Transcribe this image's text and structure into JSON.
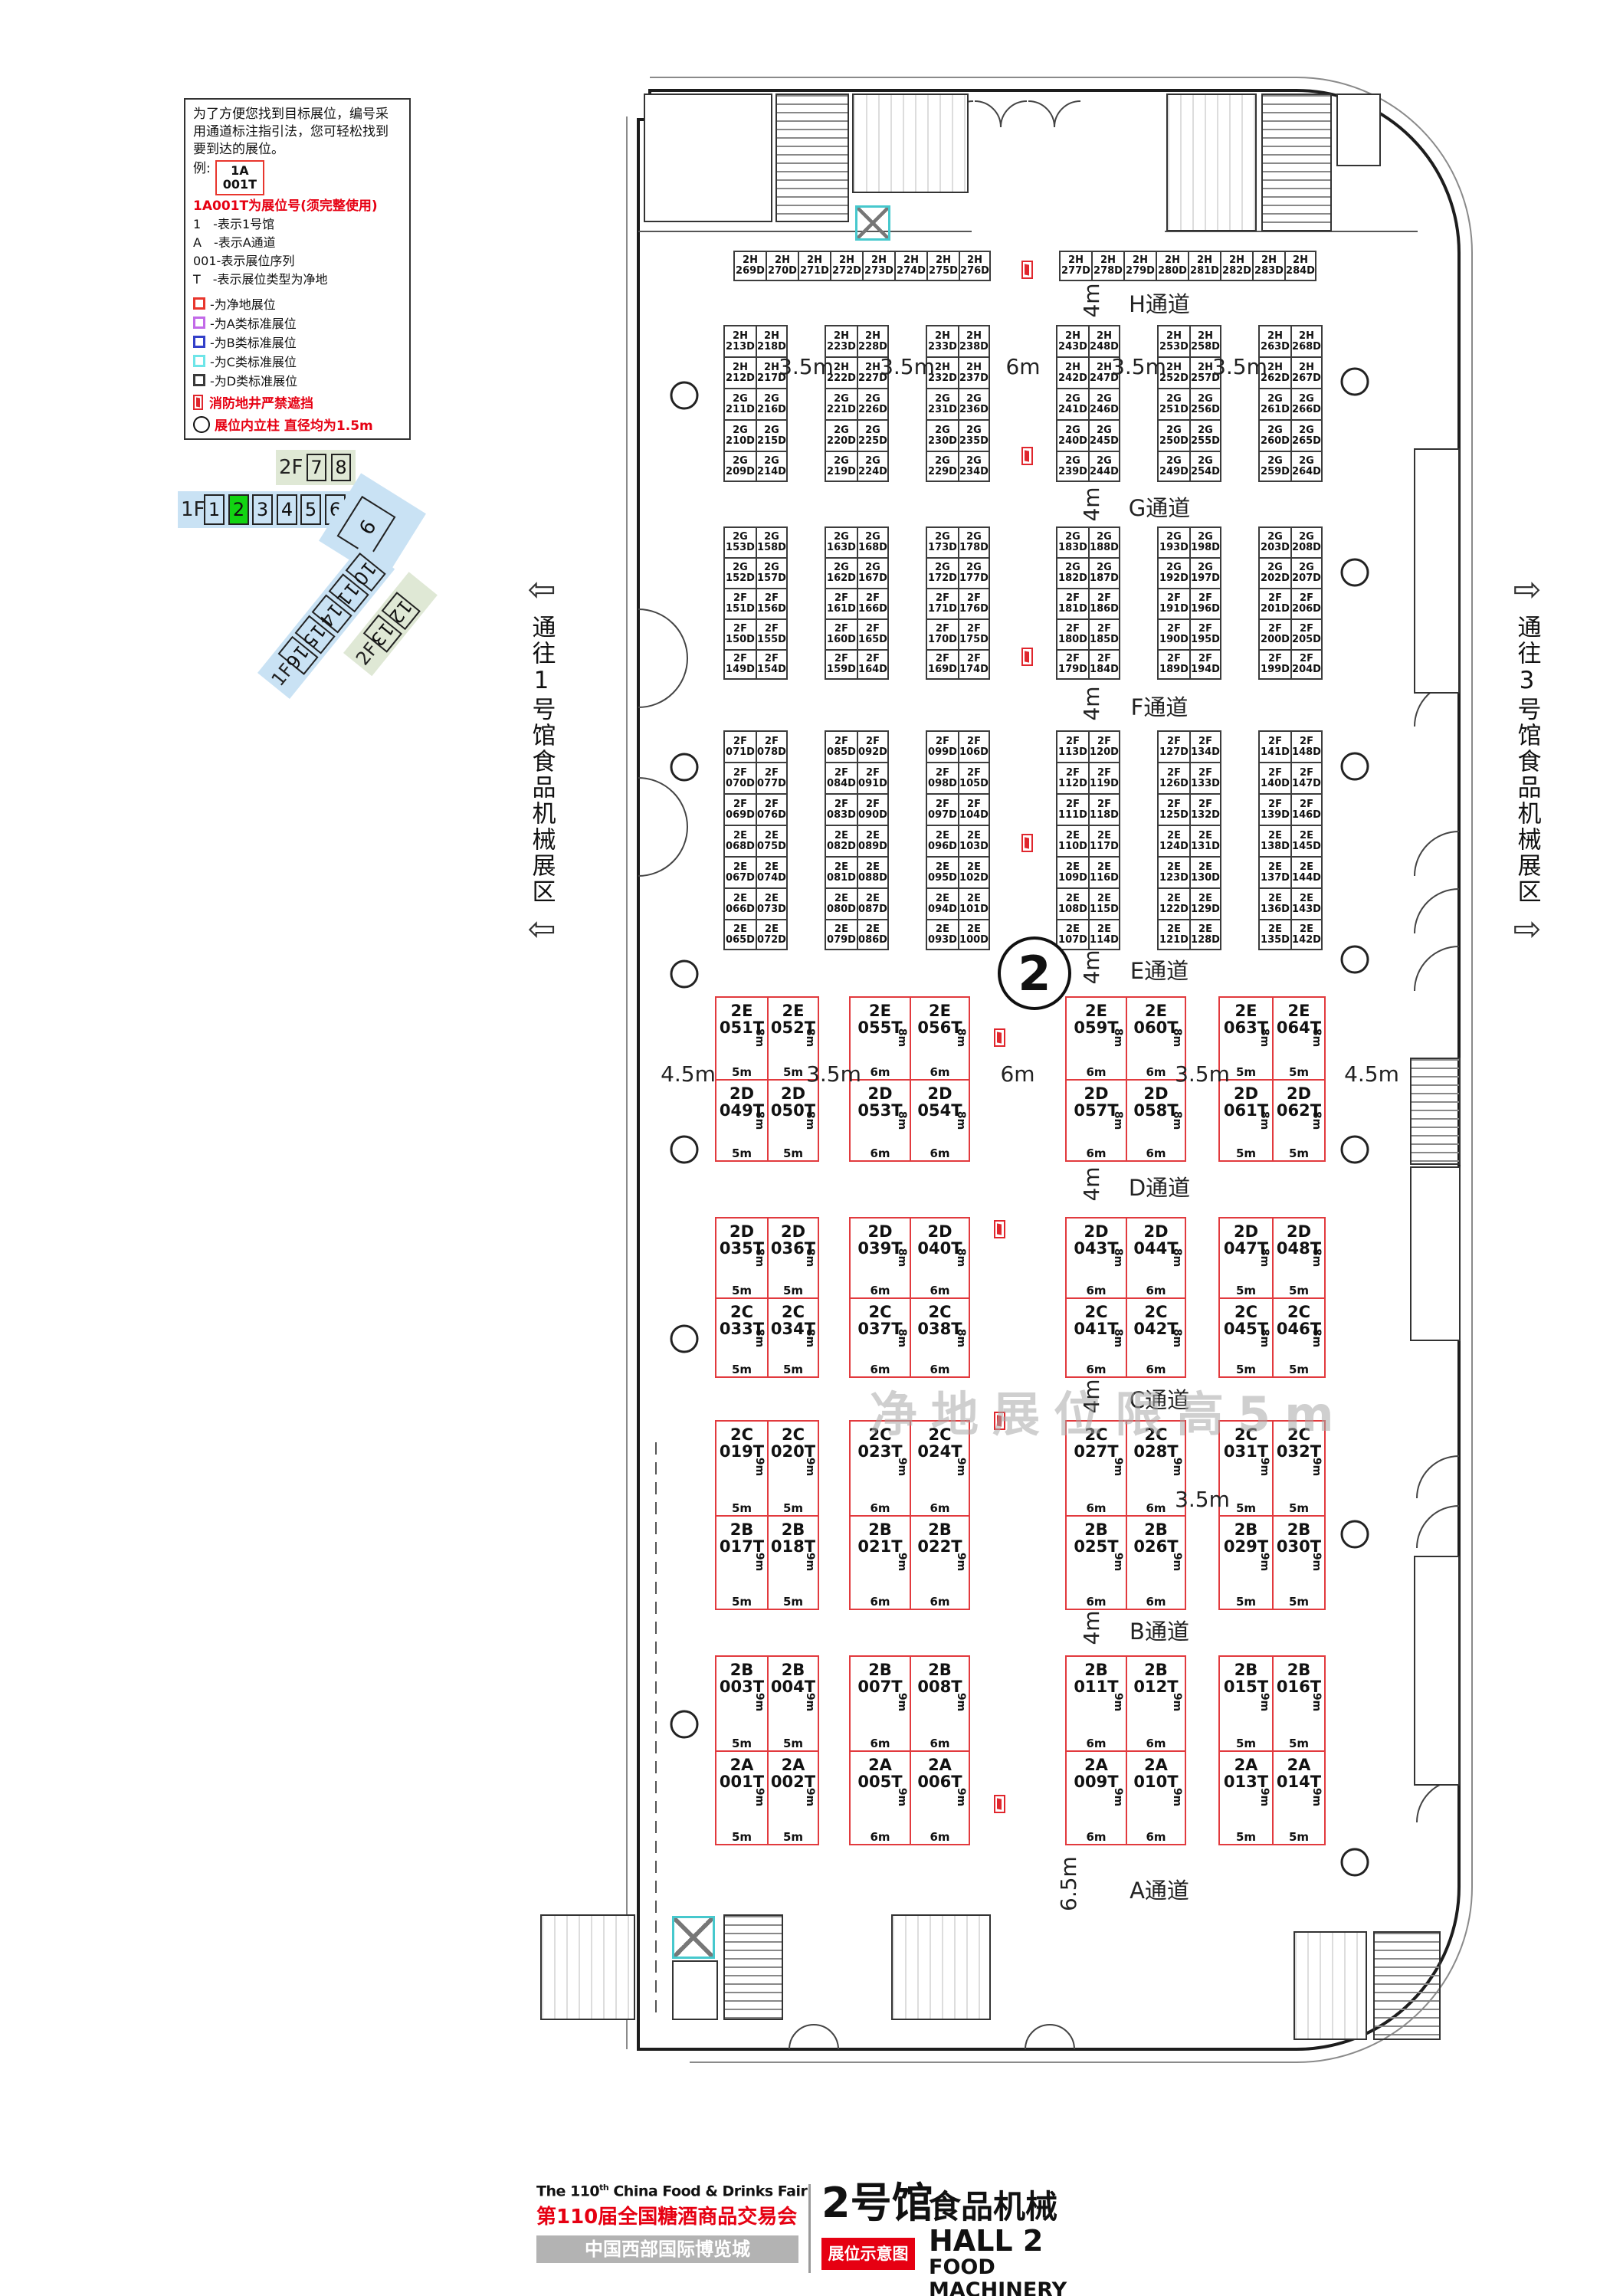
{
  "legend": {
    "intro_lines": [
      "为了方便您找到目标展位，编号采",
      "用通道标注指引法，您可轻松找到",
      "要到达的展位。"
    ],
    "example_prefix": "例:",
    "example_box_line1": "1A",
    "example_box_line2": "001T",
    "note": "1A001T为展位号(须完整使用)",
    "code_lines": [
      "1　-表示1号馆",
      "A　-表示A通道",
      "001-表示展位序列",
      "T　-表示展位类型为净地"
    ],
    "type_items": [
      {
        "color": "#e8362d",
        "label": "-为净地展位"
      },
      {
        "color": "#c26ae8",
        "label": "-为A类标准展位"
      },
      {
        "color": "#3340c9",
        "label": "-为B类标准展位"
      },
      {
        "color": "#6ee5e8",
        "label": "-为C类标准展位"
      },
      {
        "color": "#3a3a3a",
        "label": "-为D类标准展位"
      }
    ],
    "fire_note": "消防地井严禁遮挡",
    "pillar_note": "展位内立柱 直径均为1.5m"
  },
  "minimap": {
    "upper_floor_label": "2F",
    "upper_halls": [
      "7",
      "8"
    ],
    "main_floor_label": "1F",
    "main_halls": [
      "1",
      "2",
      "3",
      "4",
      "5",
      "6"
    ],
    "highlight_hall": "2",
    "hall_9": "9",
    "diag_floor_label": "1F",
    "diag_halls": [
      "10",
      "11",
      "14",
      "15",
      "16"
    ],
    "diag2_floor_label": "2F",
    "diag2_halls": [
      "12",
      "13"
    ]
  },
  "side_labels": {
    "left_text": "通往1号馆食品机械展区",
    "right_text": "通往3号馆食品机械展区",
    "left_arrow": "⇦",
    "right_arrow": "⇨"
  },
  "hall_circle_number": "2",
  "watermark": "净地展位限高5m",
  "band1_gaps": [
    "3.5m",
    "3.5m",
    "6m",
    "3.5m",
    "3.5m"
  ],
  "aisles": [
    {
      "name": "H通道",
      "width": "4m"
    },
    {
      "name": "G通道",
      "width": "4m"
    },
    {
      "name": "F通道",
      "width": "4m"
    },
    {
      "name": "E通道",
      "width": "4m"
    },
    {
      "name": "D通道",
      "width": "4m"
    },
    {
      "name": "C通道",
      "width": "4m"
    },
    {
      "name": "B通道",
      "width": "4m"
    },
    {
      "name": "A通道",
      "width": "6.5m"
    }
  ],
  "top_row": {
    "groups": [
      [
        "2H\n269D",
        "2H\n270D",
        "2H\n271D",
        "2H\n272D",
        "2H\n273D",
        "2H\n274D",
        "2H\n275D",
        "2H\n276D"
      ],
      [
        "2H\n277D",
        "2H\n278D",
        "2H\n279D",
        "2H\n280D",
        "2H\n281D",
        "2H\n282D",
        "2H\n283D",
        "2H\n284D"
      ]
    ]
  },
  "upper_bands": [
    {
      "blocks": [
        [
          [
            "2H\n213D",
            "2H\n218D"
          ],
          [
            "2H\n212D",
            "2H\n217D"
          ],
          [
            "2G\n211D",
            "2G\n216D"
          ],
          [
            "2G\n210D",
            "2G\n215D"
          ],
          [
            "2G\n209D",
            "2G\n214D"
          ]
        ],
        [
          [
            "2H\n223D",
            "2H\n228D"
          ],
          [
            "2H\n222D",
            "2H\n227D"
          ],
          [
            "2G\n221D",
            "2G\n226D"
          ],
          [
            "2G\n220D",
            "2G\n225D"
          ],
          [
            "2G\n219D",
            "2G\n224D"
          ]
        ],
        [
          [
            "2H\n233D",
            "2H\n238D"
          ],
          [
            "2H\n232D",
            "2H\n237D"
          ],
          [
            "2G\n231D",
            "2G\n236D"
          ],
          [
            "2G\n230D",
            "2G\n235D"
          ],
          [
            "2G\n229D",
            "2G\n234D"
          ]
        ],
        [
          [
            "2H\n243D",
            "2H\n248D"
          ],
          [
            "2H\n242D",
            "2H\n247D"
          ],
          [
            "2G\n241D",
            "2G\n246D"
          ],
          [
            "2G\n240D",
            "2G\n245D"
          ],
          [
            "2G\n239D",
            "2G\n244D"
          ]
        ],
        [
          [
            "2H\n253D",
            "2H\n258D"
          ],
          [
            "2H\n252D",
            "2H\n257D"
          ],
          [
            "2G\n251D",
            "2G\n256D"
          ],
          [
            "2G\n250D",
            "2G\n255D"
          ],
          [
            "2G\n249D",
            "2G\n254D"
          ]
        ],
        [
          [
            "2H\n263D",
            "2H\n268D"
          ],
          [
            "2H\n262D",
            "2H\n267D"
          ],
          [
            "2G\n261D",
            "2G\n266D"
          ],
          [
            "2G\n260D",
            "2G\n265D"
          ],
          [
            "2G\n259D",
            "2G\n264D"
          ]
        ]
      ]
    },
    {
      "blocks": [
        [
          [
            "2G\n153D",
            "2G\n158D"
          ],
          [
            "2G\n152D",
            "2G\n157D"
          ],
          [
            "2F\n151D",
            "2F\n156D"
          ],
          [
            "2F\n150D",
            "2F\n155D"
          ],
          [
            "2F\n149D",
            "2F\n154D"
          ]
        ],
        [
          [
            "2G\n163D",
            "2G\n168D"
          ],
          [
            "2G\n162D",
            "2G\n167D"
          ],
          [
            "2F\n161D",
            "2F\n166D"
          ],
          [
            "2F\n160D",
            "2F\n165D"
          ],
          [
            "2F\n159D",
            "2F\n164D"
          ]
        ],
        [
          [
            "2G\n173D",
            "2G\n178D"
          ],
          [
            "2G\n172D",
            "2G\n177D"
          ],
          [
            "2F\n171D",
            "2F\n176D"
          ],
          [
            "2F\n170D",
            "2F\n175D"
          ],
          [
            "2F\n169D",
            "2F\n174D"
          ]
        ],
        [
          [
            "2G\n183D",
            "2G\n188D"
          ],
          [
            "2G\n182D",
            "2G\n187D"
          ],
          [
            "2F\n181D",
            "2F\n186D"
          ],
          [
            "2F\n180D",
            "2F\n185D"
          ],
          [
            "2F\n179D",
            "2F\n184D"
          ]
        ],
        [
          [
            "2G\n193D",
            "2G\n198D"
          ],
          [
            "2G\n192D",
            "2G\n197D"
          ],
          [
            "2F\n191D",
            "2F\n196D"
          ],
          [
            "2F\n190D",
            "2F\n195D"
          ],
          [
            "2F\n189D",
            "2F\n194D"
          ]
        ],
        [
          [
            "2G\n203D",
            "2G\n208D"
          ],
          [
            "2G\n202D",
            "2G\n207D"
          ],
          [
            "2F\n201D",
            "2F\n206D"
          ],
          [
            "2F\n200D",
            "2F\n205D"
          ],
          [
            "2F\n199D",
            "2F\n204D"
          ]
        ]
      ]
    },
    {
      "blocks": [
        [
          [
            "2F\n071D",
            "2F\n078D"
          ],
          [
            "2F\n070D",
            "2F\n077D"
          ],
          [
            "2F\n069D",
            "2F\n076D"
          ],
          [
            "2E\n068D",
            "2E\n075D"
          ],
          [
            "2E\n067D",
            "2E\n074D"
          ],
          [
            "2E\n066D",
            "2E\n073D"
          ],
          [
            "2E\n065D",
            "2E\n072D"
          ]
        ],
        [
          [
            "2F\n085D",
            "2F\n092D"
          ],
          [
            "2F\n084D",
            "2F\n091D"
          ],
          [
            "2F\n083D",
            "2F\n090D"
          ],
          [
            "2E\n082D",
            "2E\n089D"
          ],
          [
            "2E\n081D",
            "2E\n088D"
          ],
          [
            "2E\n080D",
            "2E\n087D"
          ],
          [
            "2E\n079D",
            "2E\n086D"
          ]
        ],
        [
          [
            "2F\n099D",
            "2F\n106D"
          ],
          [
            "2F\n098D",
            "2F\n105D"
          ],
          [
            "2F\n097D",
            "2F\n104D"
          ],
          [
            "2E\n096D",
            "2E\n103D"
          ],
          [
            "2E\n095D",
            "2E\n102D"
          ],
          [
            "2E\n094D",
            "2E\n101D"
          ],
          [
            "2E\n093D",
            "2E\n100D"
          ]
        ],
        [
          [
            "2F\n113D",
            "2F\n120D"
          ],
          [
            "2F\n112D",
            "2F\n119D"
          ],
          [
            "2F\n111D",
            "2F\n118D"
          ],
          [
            "2E\n110D",
            "2E\n117D"
          ],
          [
            "2E\n109D",
            "2E\n116D"
          ],
          [
            "2E\n108D",
            "2E\n115D"
          ],
          [
            "2E\n107D",
            "2E\n114D"
          ]
        ],
        [
          [
            "2F\n127D",
            "2F\n134D"
          ],
          [
            "2F\n126D",
            "2F\n133D"
          ],
          [
            "2F\n125D",
            "2F\n132D"
          ],
          [
            "2E\n124D",
            "2E\n131D"
          ],
          [
            "2E\n123D",
            "2E\n130D"
          ],
          [
            "2E\n122D",
            "2E\n129D"
          ],
          [
            "2E\n121D",
            "2E\n128D"
          ]
        ],
        [
          [
            "2F\n141D",
            "2F\n148D"
          ],
          [
            "2F\n140D",
            "2F\n147D"
          ],
          [
            "2F\n139D",
            "2F\n146D"
          ],
          [
            "2E\n138D",
            "2E\n145D"
          ],
          [
            "2E\n137D",
            "2E\n144D"
          ],
          [
            "2E\n136D",
            "2E\n143D"
          ],
          [
            "2E\n135D",
            "2E\n142D"
          ]
        ]
      ]
    }
  ],
  "lower_bands": [
    {
      "gaps": [
        "4.5m",
        "3.5m",
        "6m",
        "3.5m",
        "4.5m"
      ],
      "blocks": [
        {
          "top": [
            "2E\n051T",
            "2E\n052T"
          ],
          "bottom": [
            "2D\n049T",
            "2D\n050T"
          ],
          "w": "5m",
          "h": "8m"
        },
        {
          "top": [
            "2E\n055T",
            "2E\n056T"
          ],
          "bottom": [
            "2D\n053T",
            "2D\n054T"
          ],
          "w": "6m",
          "h": "8m"
        },
        {
          "top": [
            "2E\n059T",
            "2E\n060T"
          ],
          "bottom": [
            "2D\n057T",
            "2D\n058T"
          ],
          "w": "6m",
          "h": "8m"
        },
        {
          "top": [
            "2E\n063T",
            "2E\n064T"
          ],
          "bottom": [
            "2D\n061T",
            "2D\n062T"
          ],
          "w": "5m",
          "h": "8m"
        }
      ]
    },
    {
      "gaps": [
        "",
        "",
        "",
        "",
        ""
      ],
      "blocks": [
        {
          "top": [
            "2D\n035T",
            "2D\n036T"
          ],
          "bottom": [
            "2C\n033T",
            "2C\n034T"
          ],
          "w": "5m",
          "h": "8m"
        },
        {
          "top": [
            "2D\n039T",
            "2D\n040T"
          ],
          "bottom": [
            "2C\n037T",
            "2C\n038T"
          ],
          "w": "6m",
          "h": "8m"
        },
        {
          "top": [
            "2D\n043T",
            "2D\n044T"
          ],
          "bottom": [
            "2C\n041T",
            "2C\n042T"
          ],
          "w": "6m",
          "h": "8m"
        },
        {
          "top": [
            "2D\n047T",
            "2D\n048T"
          ],
          "bottom": [
            "2C\n045T",
            "2C\n046T"
          ],
          "w": "5m",
          "h": "8m"
        }
      ]
    },
    {
      "gaps": [
        "",
        "",
        "",
        "3.5m",
        ""
      ],
      "blocks": [
        {
          "top": [
            "2C\n019T",
            "2C\n020T"
          ],
          "bottom": [
            "2B\n017T",
            "2B\n018T"
          ],
          "w": "5m",
          "h": "9m"
        },
        {
          "top": [
            "2C\n023T",
            "2C\n024T"
          ],
          "bottom": [
            "2B\n021T",
            "2B\n022T"
          ],
          "w": "6m",
          "h": "9m"
        },
        {
          "top": [
            "2C\n027T",
            "2C\n028T"
          ],
          "bottom": [
            "2B\n025T",
            "2B\n026T"
          ],
          "w": "6m",
          "h": "9m"
        },
        {
          "top": [
            "2C\n031T",
            "2C\n032T"
          ],
          "bottom": [
            "2B\n029T",
            "2B\n030T"
          ],
          "w": "5m",
          "h": "9m"
        }
      ]
    },
    {
      "gaps": [
        "",
        "",
        "",
        "",
        ""
      ],
      "blocks": [
        {
          "top": [
            "2B\n003T",
            "2B\n004T"
          ],
          "bottom": [
            "2A\n001T",
            "2A\n002T"
          ],
          "w": "5m",
          "h": "9m"
        },
        {
          "top": [
            "2B\n007T",
            "2B\n008T"
          ],
          "bottom": [
            "2A\n005T",
            "2A\n006T"
          ],
          "w": "6m",
          "h": "9m"
        },
        {
          "top": [
            "2B\n011T",
            "2B\n012T"
          ],
          "bottom": [
            "2A\n009T",
            "2A\n010T"
          ],
          "w": "6m",
          "h": "9m"
        },
        {
          "top": [
            "2B\n015T",
            "2B\n016T"
          ],
          "bottom": [
            "2A\n013T",
            "2A\n014T"
          ],
          "w": "5m",
          "h": "9m"
        }
      ]
    }
  ],
  "footer": {
    "line1_pre": "The 110",
    "line1_sup": "th",
    "line1_post": " China Food & Drinks Fair",
    "line2_cn": "第110届全国糖酒商品交易会",
    "venue": "中国西部国际博览城",
    "hall_cn": "2号馆",
    "hall_type_cn": "食品机械",
    "hall_en": "HALL 2",
    "hall_type_en": "FOOD MACHINERY",
    "badge": "展位示意图"
  },
  "colors": {
    "booth_red": "#e23a3e",
    "accent_red": "#e60012",
    "highlight_green": "#12d412",
    "minimap_blue": "#c9e2f4",
    "minimap_green": "#dfe8d5"
  }
}
